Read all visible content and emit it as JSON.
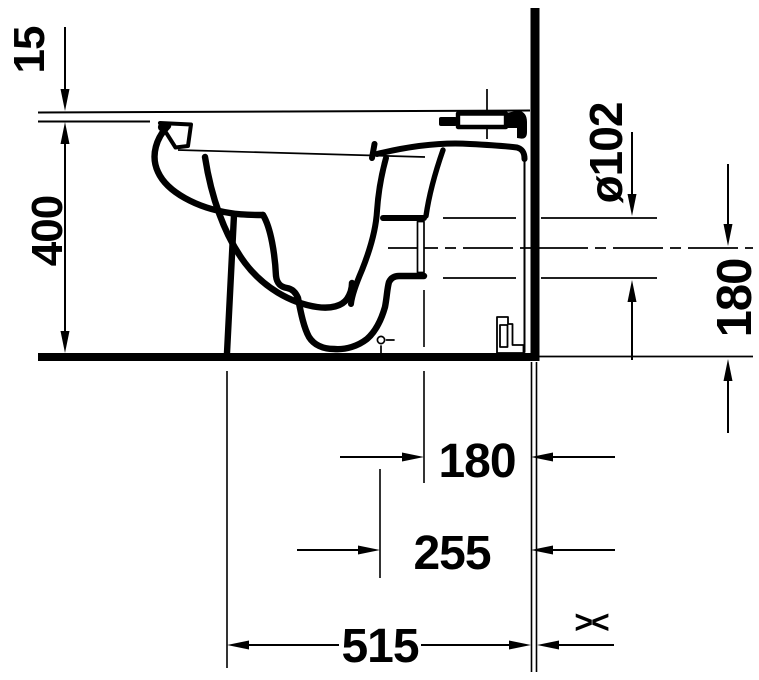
{
  "drawing": {
    "background_color": "#ffffff",
    "line_color": "#000000",
    "subject": "toilet-side-elevation-technical-drawing"
  },
  "dim_labels": {
    "seat_height": "15",
    "rim_height": "400",
    "outlet_diameter": "ø102",
    "outlet_axis_height": "180",
    "outlet_to_wall": "180",
    "fixing_to_wall": "255",
    "depth_to_wall": "515",
    "variable_symbol": "&gt;&lt;"
  }
}
